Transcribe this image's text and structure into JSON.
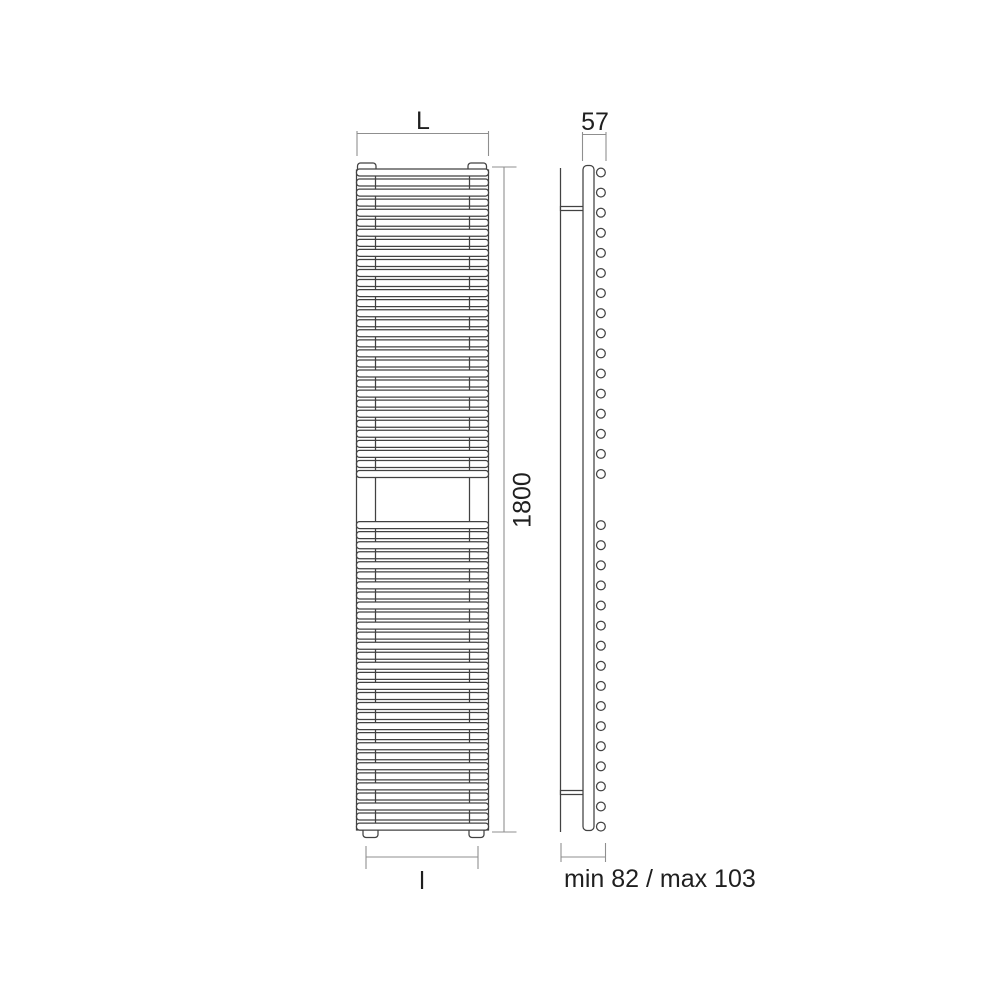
{
  "figure": {
    "type": "technical-dimension-drawing",
    "subject": "vertical towel-rail radiator, front view and side view",
    "background_color": "#ffffff",
    "line_color": "#424242",
    "dimension_line_color": "#8f8f8f",
    "text_color": "#1f1f1f"
  },
  "labels": {
    "front_width": "L",
    "front_height": "1800",
    "front_pipe_distance": "l",
    "side_depth": "57",
    "side_wall_distance": "min 82 / max 103"
  },
  "geometry": {
    "front": {
      "x0": 356.5,
      "width": 132,
      "collector_width": 19,
      "bar_height": 7,
      "bar_pitch": 10.05,
      "corner_radius": 3,
      "sections": [
        {
          "start_y": 169.0,
          "rows": 31
        },
        {
          "start_y": 521.6,
          "rows": 31
        }
      ]
    },
    "side": {
      "circle_cx": 600.9,
      "circle_r": 4.4
    }
  }
}
